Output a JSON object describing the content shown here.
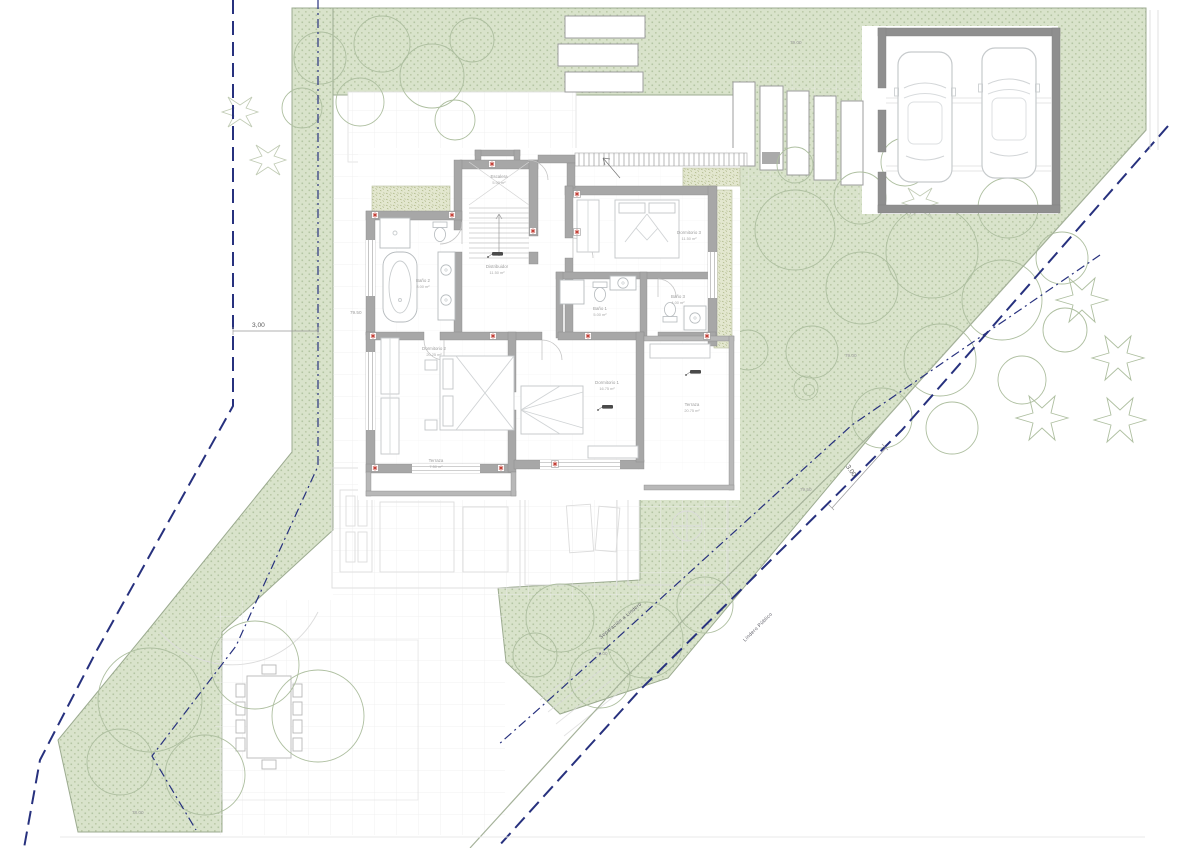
{
  "plan": {
    "rooms": [
      {
        "name": "Escalera",
        "area": "5.00 m²"
      },
      {
        "name": "Baño 2",
        "area": "8.00 m²"
      },
      {
        "name": "Distribuidor",
        "area": "11.50 m²"
      },
      {
        "name": "Dormitorio 3",
        "area": "11.50 m²"
      },
      {
        "name": "Baño 1",
        "area": "5.00 m²"
      },
      {
        "name": "Baño 3",
        "area": "4.00 m²"
      },
      {
        "name": "Dormitorio 2",
        "area": "20.25 m²"
      },
      {
        "name": "Dormitorio 1",
        "area": "16.75 m²"
      },
      {
        "name": "Terraza",
        "area": "7.50 m²"
      },
      {
        "name": "Terraza",
        "area": "20.75 m²"
      }
    ],
    "levels": {
      "top": "79.00",
      "left": "79.50",
      "right": "79.00",
      "diagonal": "79.50",
      "bottom_center": "78.00",
      "bottom_left": "78.00"
    },
    "setbacks": {
      "left": "3,00",
      "diagonal": "3.00"
    },
    "boundaries": {
      "inner": "Separación a Lindero",
      "outer": "Lindero Público"
    },
    "colors": {
      "greenery": "#d9e3cb",
      "greenery_dot": "#b4c5a3",
      "green_edge": "#9cab90",
      "wall_gray": "#a7a7a7",
      "boundary_navy": "#27317e",
      "marker_red": "#c23b32"
    }
  }
}
